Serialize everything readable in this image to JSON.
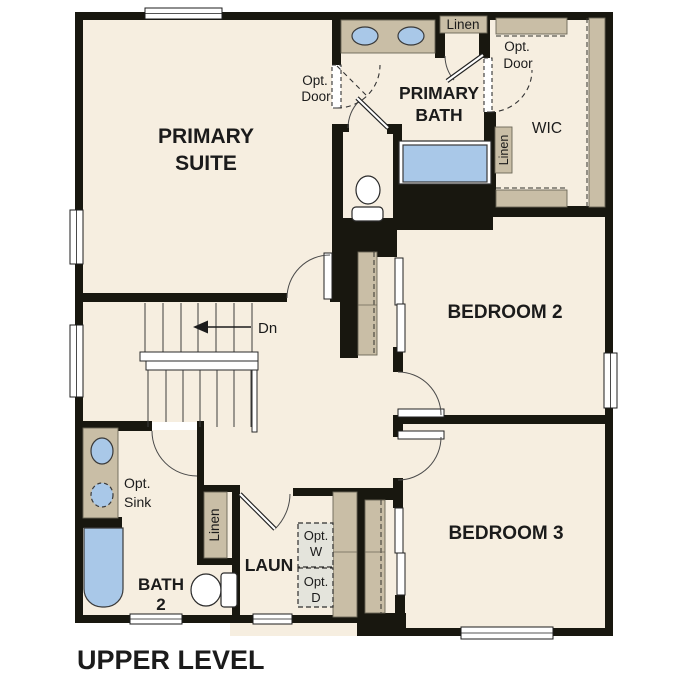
{
  "title": "UPPER LEVEL",
  "rooms": {
    "primary_suite": [
      "PRIMARY",
      "SUITE"
    ],
    "primary_bath": [
      "PRIMARY",
      "BATH"
    ],
    "bedroom2": "BEDROOM 2",
    "bedroom3": "BEDROOM 3",
    "bath2": [
      "BATH",
      "2"
    ],
    "laundry": "LAUN",
    "wic": "WIC"
  },
  "annotations": {
    "stairs_down": "Dn",
    "linen_primary_bath": "Linen",
    "linen_wic": "Linen",
    "linen_bath2": "Linen",
    "opt_door_suite": [
      "Opt.",
      "Door"
    ],
    "opt_door_wic": [
      "Opt.",
      "Door"
    ],
    "opt_sink": [
      "Opt.",
      "Sink"
    ],
    "opt_washer": [
      "Opt.",
      "W"
    ],
    "opt_dryer": [
      "Opt.",
      "D"
    ]
  },
  "colors": {
    "floor": "#f6eee0",
    "wall": "#18170f",
    "casework": "#c9bea6",
    "fixture_blue": "#a9c8e8",
    "optional_gray": "#e4e4dc"
  }
}
